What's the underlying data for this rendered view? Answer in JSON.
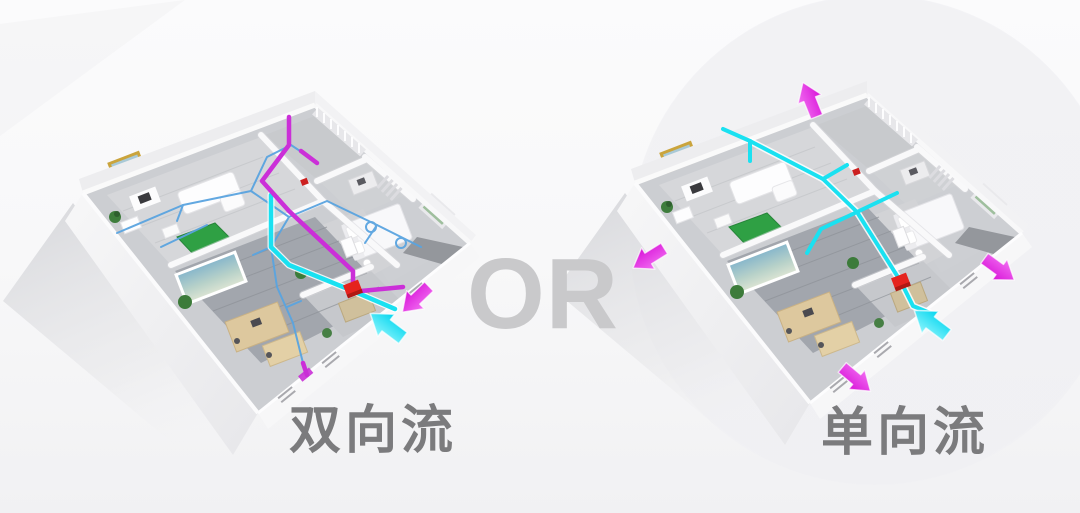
{
  "comparison": {
    "separator_label": "OR",
    "systems": [
      {
        "id": "bidirectional",
        "label": "双向流"
      },
      {
        "id": "unidirectional",
        "label": "单向流"
      }
    ]
  },
  "legend_colors": {
    "fresh_air_duct": "#1ae1f1",
    "exhaust_air_duct": "#cb2fd8",
    "branch_duct": "#5aa4e0",
    "ventilation_unit_red": "#e5231e",
    "label_gray": "#7b7b7d",
    "separator_gray": "#c9c9cb"
  },
  "icons": {
    "fresh_air_arrow": "fresh-air-intake-arrow-icon",
    "exhaust_air_arrow": "exhaust-air-outlet-arrow-icon"
  }
}
